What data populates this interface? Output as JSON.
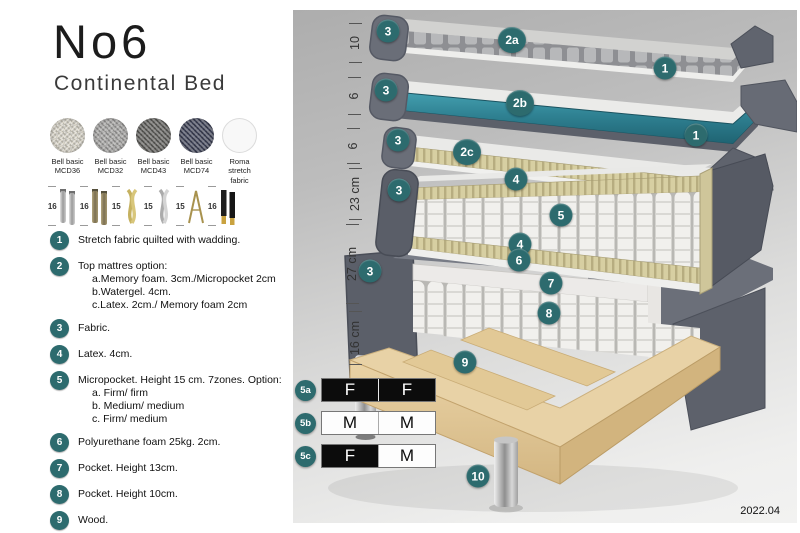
{
  "header": {
    "title": "No6",
    "subtitle": "Continental Bed"
  },
  "swatches": [
    {
      "line1": "Bell basic",
      "line2": "MCD36",
      "color": "#d8d4c8"
    },
    {
      "line1": "Bell basic",
      "line2": "MCD32",
      "color": "#a5a4a2"
    },
    {
      "line1": "Bell basic",
      "line2": "MCD43",
      "color": "#62615e"
    },
    {
      "line1": "Bell basic",
      "line2": "MCD74",
      "color": "#42465a"
    },
    {
      "line1": "Roma",
      "line2": "stretch fabric",
      "color": "#f8f8f8"
    }
  ],
  "legs": [
    {
      "height": "16",
      "type": "cylinder-silver-leg"
    },
    {
      "height": "16",
      "type": "cylinder-bronze-leg"
    },
    {
      "height": "15",
      "type": "twisted-gold-leg"
    },
    {
      "height": "15",
      "type": "twisted-silver-leg"
    },
    {
      "height": "15",
      "type": "hairpin-gold-leg"
    },
    {
      "height": "16",
      "type": "black-gold-leg"
    }
  ],
  "legend": {
    "items": [
      {
        "num": "1",
        "text": "Stretch fabric quilted with wadding."
      },
      {
        "num": "2",
        "text": "Top mattres option:",
        "subs": [
          "a.Memory foam. 3cm./Micropocket 2cm",
          "b.Watergel. 4cm.",
          "c.Latex. 2cm./ Memory foam 2cm"
        ]
      },
      {
        "num": "3",
        "text": "Fabric."
      },
      {
        "num": "4",
        "text": "Latex. 4cm."
      },
      {
        "num": "5",
        "text": "Micropocket. Height 15 cm. 7zones. Option:",
        "subs": [
          "a. Firm/ firm",
          "b. Medium/ medium",
          "c. Firm/ medium"
        ]
      },
      {
        "num": "6",
        "text": "Polyurethane foam 25kg. 2cm."
      },
      {
        "num": "7",
        "text": "Pocket. Height 13cm."
      },
      {
        "num": "8",
        "text": "Pocket. Height 10cm."
      },
      {
        "num": "9",
        "text": "Wood."
      },
      {
        "num": "10",
        "text": "Metal leg. Height 16cm."
      }
    ]
  },
  "diagram": {
    "dimensions": [
      "10",
      "6",
      "6",
      "23 cm",
      "27 cm",
      "16 cm"
    ],
    "badges": [
      "3",
      "2a",
      "1",
      "3",
      "2b",
      "1",
      "3",
      "2c",
      "3",
      "4",
      "5",
      "4",
      "3",
      "6",
      "7",
      "8",
      "9",
      "10"
    ],
    "firmness": [
      {
        "id": "5a",
        "cells": [
          {
            "letter": "F",
            "style": "dark"
          },
          {
            "letter": "F",
            "style": "dark"
          }
        ]
      },
      {
        "id": "5b",
        "cells": [
          {
            "letter": "M",
            "style": "light"
          },
          {
            "letter": "M",
            "style": "light"
          }
        ]
      },
      {
        "id": "5c",
        "cells": [
          {
            "letter": "F",
            "style": "dark"
          },
          {
            "letter": "M",
            "style": "light"
          }
        ]
      }
    ],
    "date": "2022.04"
  },
  "colors": {
    "badge_teal": "#2d6b6e",
    "watergel_teal": "#2f8192",
    "latex_tan": "#d6cda0",
    "side_gray": "#5f636d",
    "wood": "#e6cfa0",
    "panel_top": "#adadad",
    "panel_bottom": "#f2f2f1"
  }
}
